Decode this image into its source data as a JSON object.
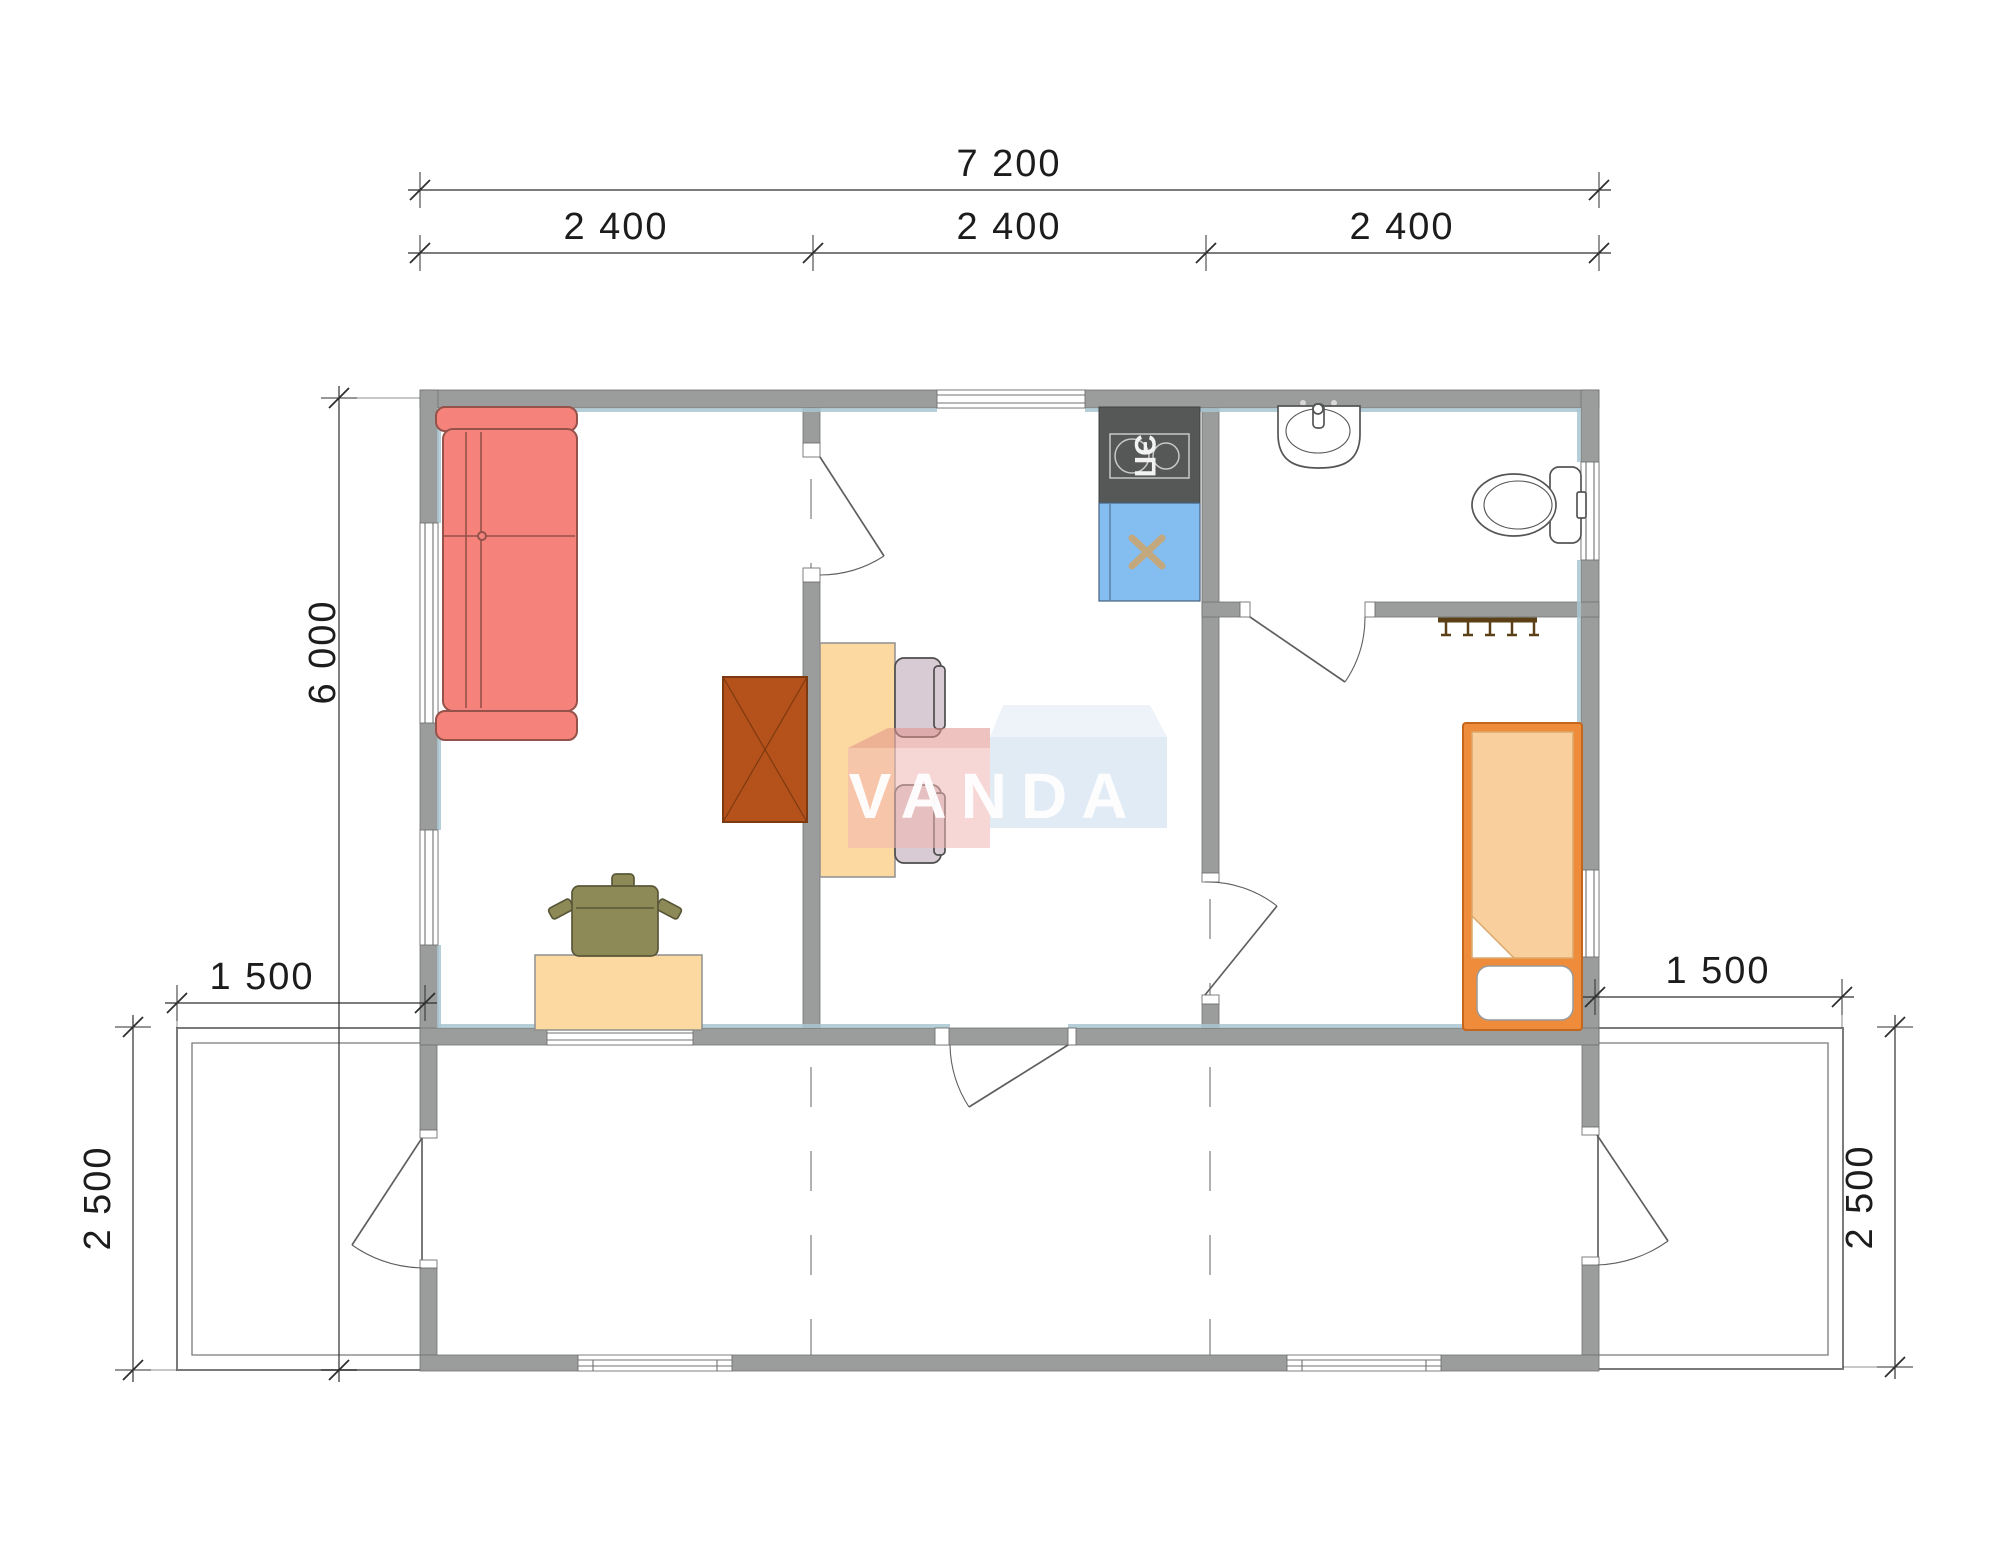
{
  "brand": {
    "name": "VANDA"
  },
  "dimensions": {
    "top_total": "7 200",
    "top_modules": [
      "2 400",
      "2 400",
      "2 400"
    ],
    "side_total": "6 000",
    "terrace_left_width": "1 500",
    "terrace_left_depth": "2 500",
    "terrace_right_width": "1 500",
    "terrace_right_depth": "2 500"
  },
  "labels": {
    "stove": "ЭП"
  },
  "furniture_icons": [
    "corner-sofa-icon",
    "wardrobe-icon",
    "dining-table-icon",
    "chair-icon",
    "office-desk-icon",
    "office-chair-icon",
    "electric-stove-icon",
    "kitchen-sink-icon",
    "washbasin-icon",
    "toilet-icon",
    "coat-rack-icon",
    "single-bed-icon"
  ],
  "colors": {
    "wall": "#9b9d9c",
    "wallEdge": "#707271",
    "lining": "#a9c6d1",
    "dimLine": "#2e2e2e",
    "dimText": "#1c1c1c",
    "grid": "#909090",
    "door": "#5f5f5f",
    "windowLine": "#707271",
    "sofa": "#f5837b",
    "sofaLine": "#94524a",
    "wardrobe": "#b5521b",
    "wardrobeLine": "#7d3910",
    "table": "#fcd9a0",
    "tableLine": "#8f8f8f",
    "chair": "#d9cbd3",
    "chairLine": "#4d4d4d",
    "officeChair": "#8e8a57",
    "officeChairLine": "#5a5738",
    "stove": "#565857",
    "stoveDetail": "#c7c8c7",
    "stoveText": "#f2f2f2",
    "sink": "#84bdf0",
    "sinkEdge": "#46627e",
    "sinkCross": "#c3a87e",
    "bedFrame": "#ee8c3b",
    "bedFrameLine": "#c4671c",
    "blanket": "#f8cf9d",
    "blanketLine": "#dca96b",
    "pillowLine": "#9a9a9a",
    "fixture": "#555555",
    "rack": "#5a3f17",
    "terrace": "#7a7a7a",
    "logoRed": "#f2b7b3",
    "logoRedTop": "#e1928b",
    "logoBlue": "#c9dbec",
    "logoBlueTop": "#dfebf5",
    "logoText": "#ffffff"
  }
}
